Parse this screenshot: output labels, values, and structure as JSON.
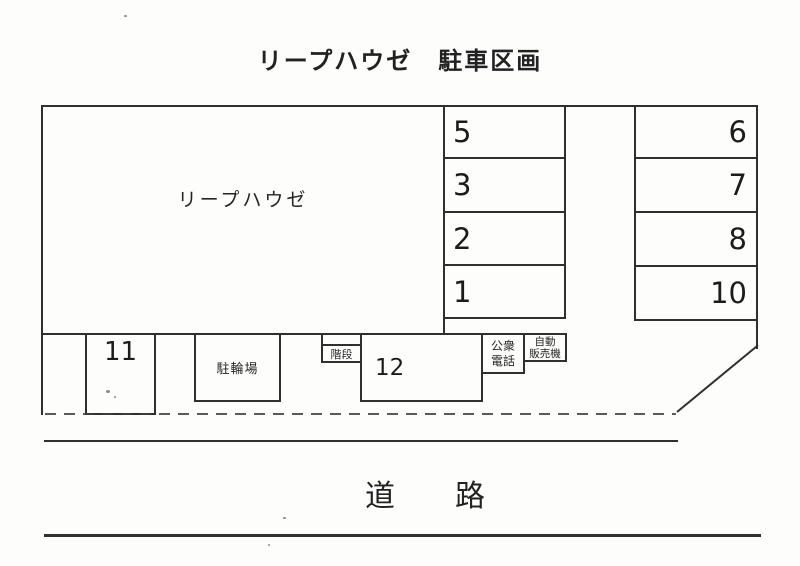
{
  "page": {
    "title": "リープハウゼ　駐車区画",
    "building_label": "リープハウゼ",
    "road_label": "道　　路"
  },
  "parking_spaces": {
    "middle_column": [
      "5",
      "3",
      "2",
      "1"
    ],
    "right_column": [
      "6",
      "7",
      "8",
      "10"
    ]
  },
  "bottom_row": {
    "space_11": "11",
    "bicycle_parking": "駐輪場",
    "stairs": "階段",
    "space_12": "12",
    "public_phone": "公衆\n電話",
    "vending_machine": "自動\n販売機"
  },
  "colors": {
    "paper": "#fdfdfc",
    "line": "#2f2f2f",
    "text": "#1f1f1f"
  }
}
